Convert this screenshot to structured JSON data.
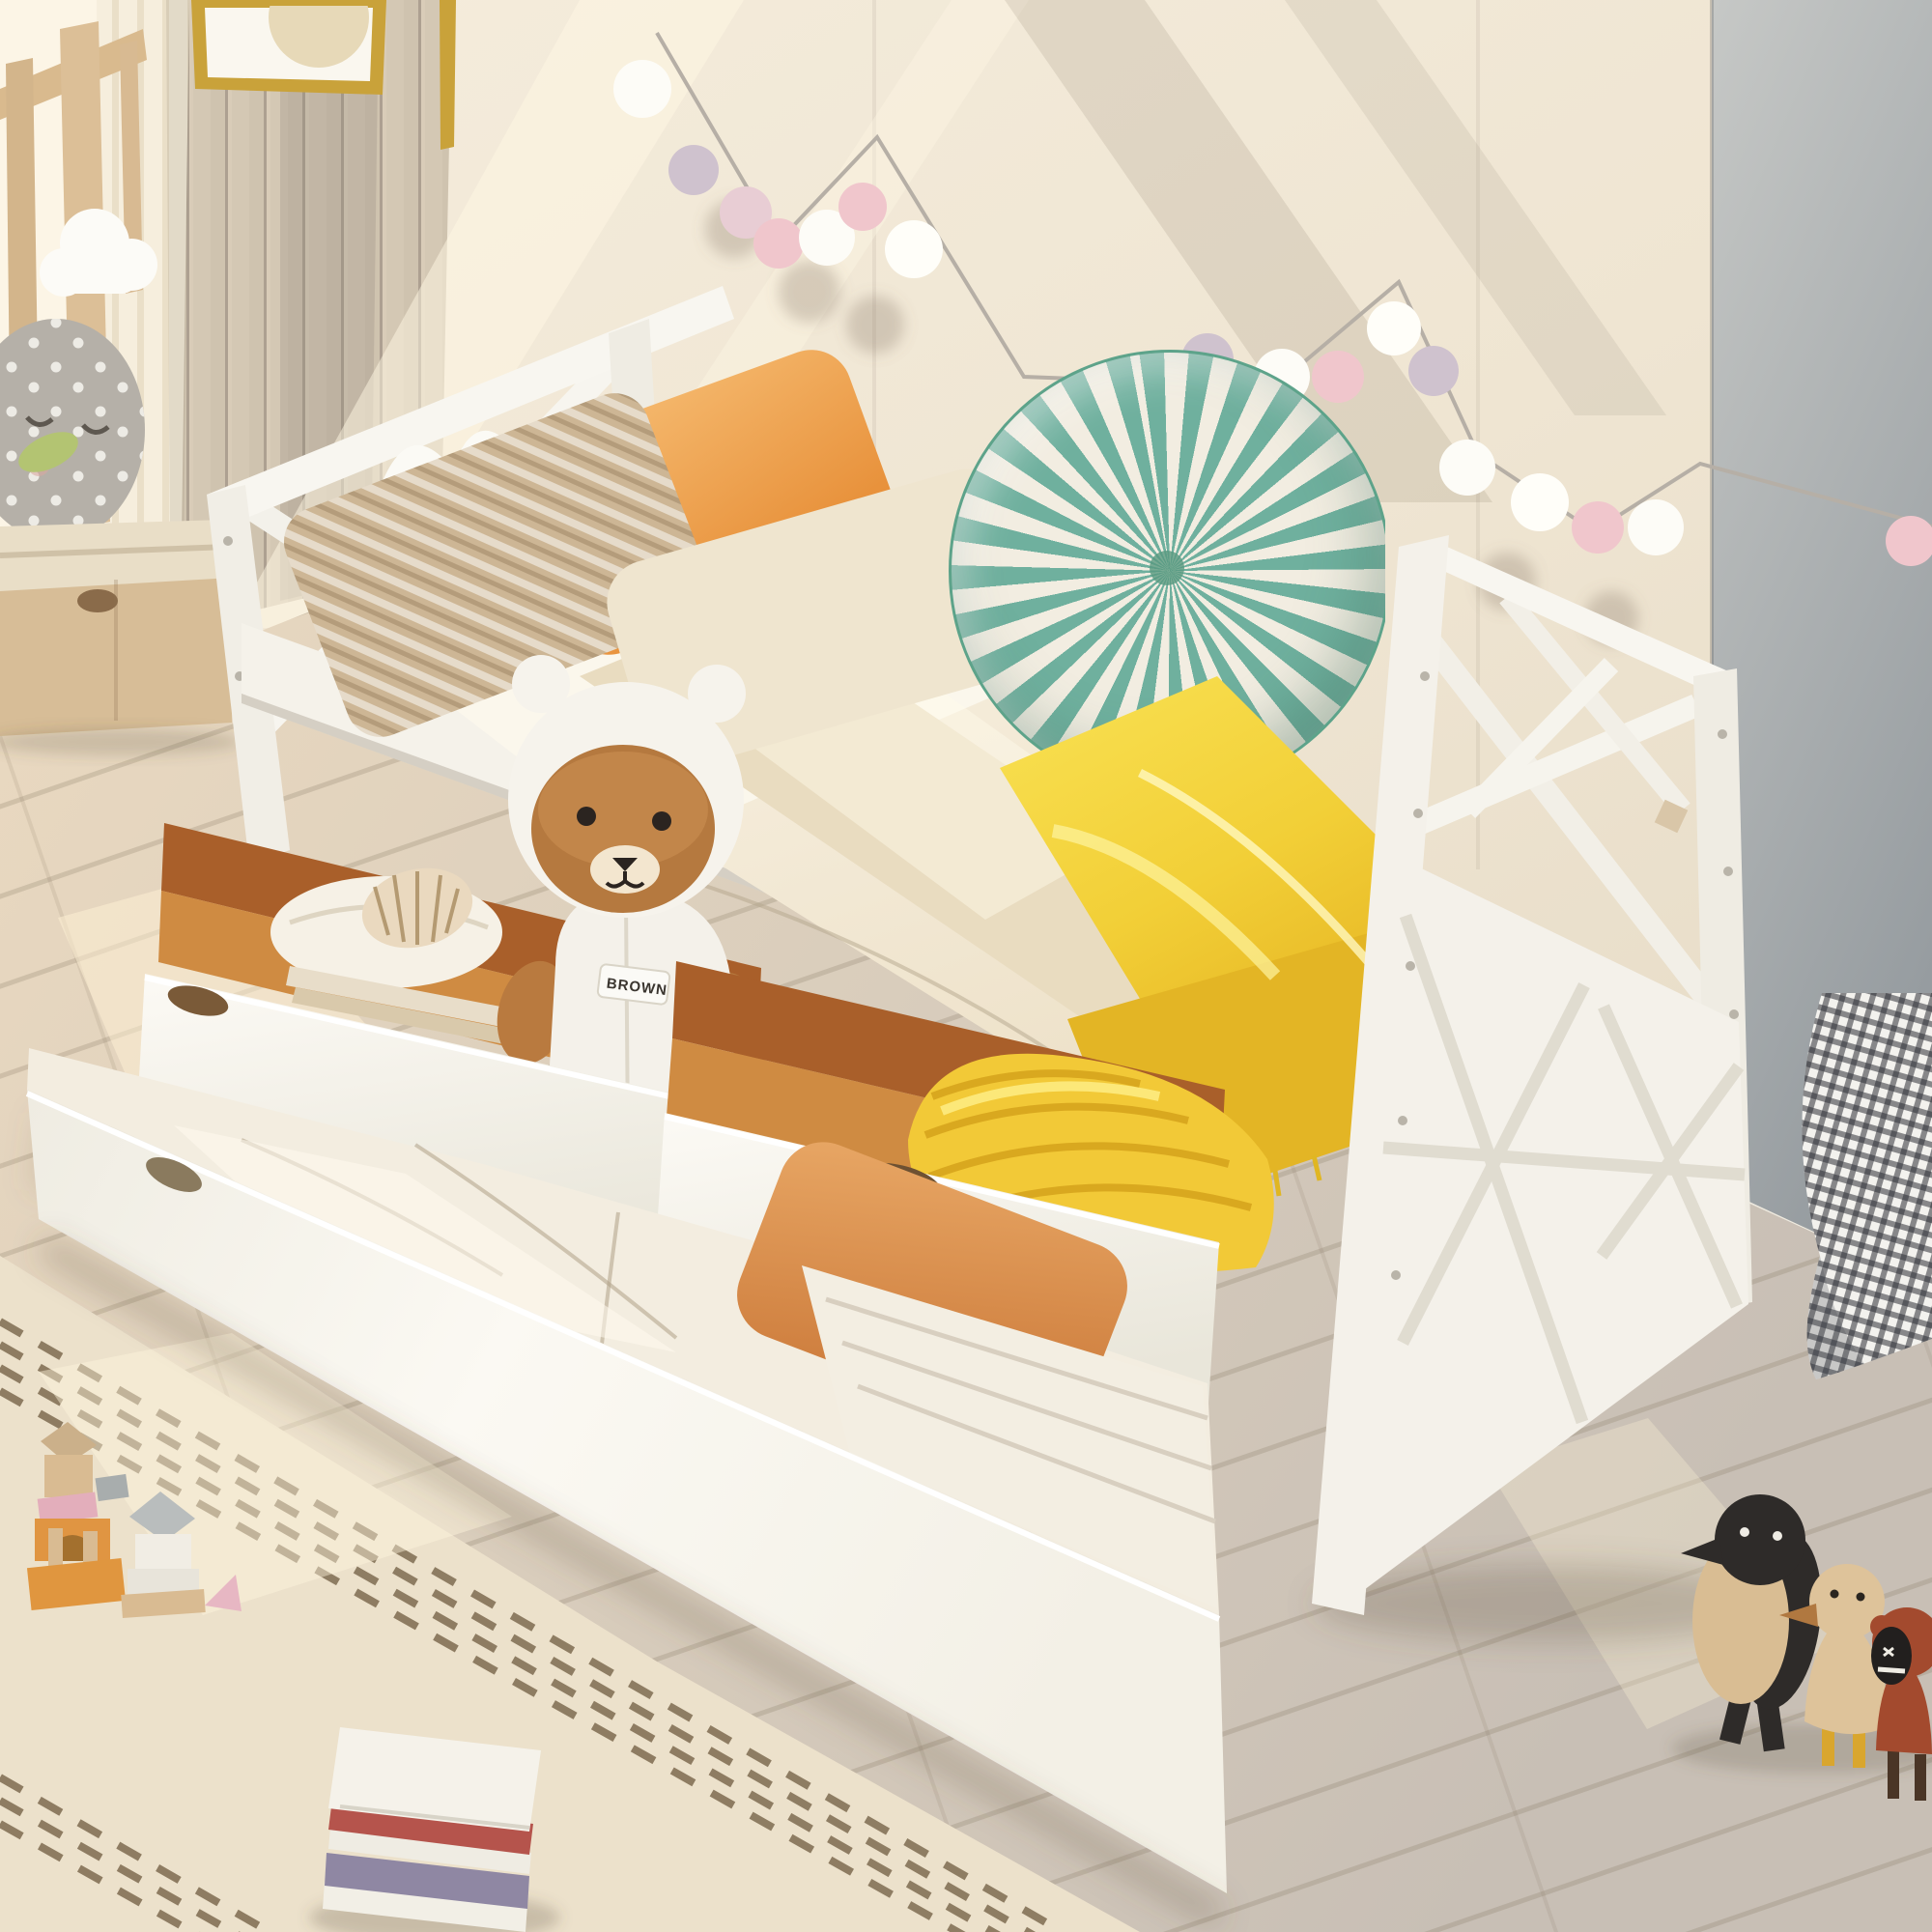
{
  "image": {
    "kind": "furniture-product-photo",
    "subject": "White wooden twin daybed with X-pattern headboard and footboard, two pulled-out storage drawers and an extended trundle bed, staged in a sunny kids bedroom"
  },
  "bear": {
    "label": "BROWN",
    "description": "brown plush bear wearing a white hooded costume standing in the open storage drawer"
  },
  "room": {
    "wall_left": "vertical wood paneling with gold-framed picture",
    "wall_main": "cream paneled wall with pom-pom garland",
    "wall_right": "gray-blue wall with white baseboard",
    "floor": "light oak planks",
    "rug": "cream rug with brown dashed stripe bands"
  },
  "objects": [
    "gold-framed-picture",
    "sheer-curtain",
    "wood-crib-rail",
    "cloud-ornament",
    "polka-dot-owl-pillow",
    "window-bench-with-drawer",
    "pom-pom-garland",
    "open-book-on-headboard",
    "woven-pillow",
    "orange-pillow",
    "cream-pillow",
    "teal-pinwheel-round-pillow",
    "yellow-satin-blanket",
    "storage-drawer-left",
    "storage-drawer-right",
    "seashell",
    "folded-blanket",
    "books-in-drawer",
    "brown-bear-plush",
    "yellow-striped-blanket-roll",
    "trundle-bed",
    "trundle-orange-pillow",
    "white-piped-blanket",
    "gingham-floor-cushion",
    "wooden-toy-blocks",
    "stacked-books",
    "wooden-penguin-toy",
    "wooden-duck-toy",
    "wooden-red-duck-toy"
  ],
  "palette": {
    "wall_cream": "#f2e9d8",
    "wall_right_gray": "#a9aeb0",
    "paneling_tan": "#c9bdac",
    "bed_frame_white": "#f7f5ef",
    "drawer_interior_wood": "#c07a39",
    "mattress_cream": "#f7efdf",
    "blanket_yellow": "#f2cf37",
    "pillow_orange": "#efa755",
    "trundle_pillow_orange": "#d9884a",
    "pillow_round_teal": "#6fb09e",
    "bear_brown": "#b5793f",
    "bear_hood_white": "#f5f2ea",
    "garland_white": "#fdfcf7",
    "garland_pink": "#f0c6cc",
    "garland_lavender": "#cfc2ce",
    "rug_cream": "#ece1cb",
    "rug_dash_brown": "#6f5b40",
    "floor_wood": "#dccfbc",
    "frame_gold": "#c9a23a"
  }
}
